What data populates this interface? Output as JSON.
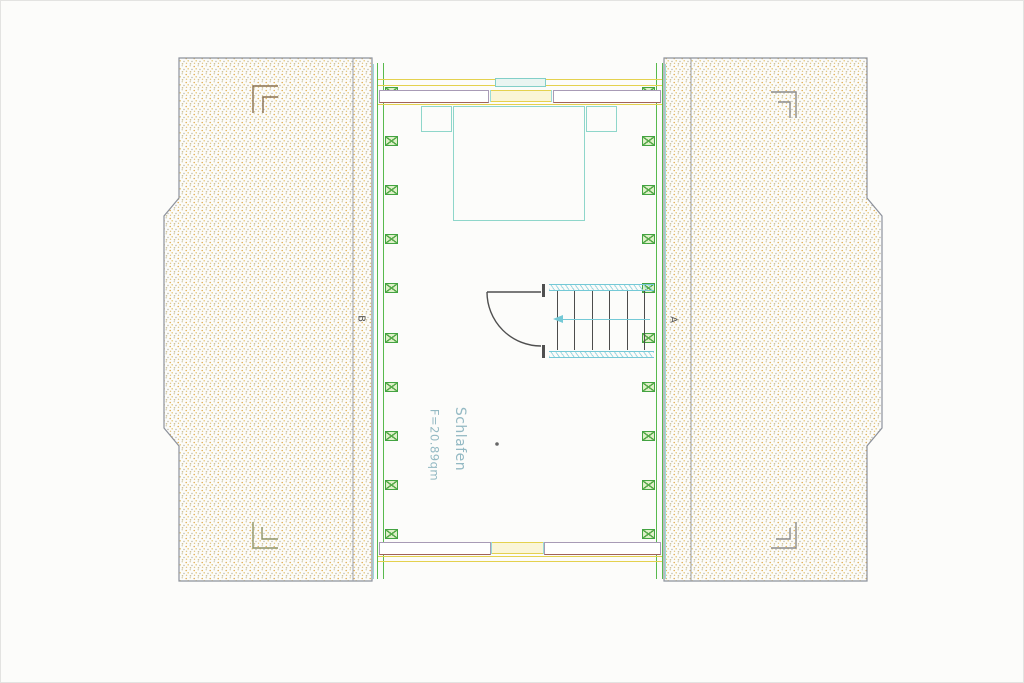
{
  "room": {
    "name": "Schlafen",
    "area": "F=20.89qm"
  },
  "section_markers": {
    "left": "B",
    "right": "A"
  },
  "structure": {
    "rafter_blocks_per_side": 10,
    "stair_tread_lines": 6,
    "stair_direction": "left"
  },
  "colors": {
    "wall_green": "#58ba4d",
    "rafter_fill": "#dff0c9",
    "stipple_orange": "#dfae55",
    "stipple_olive": "#cdc7a4",
    "knee_wall_purple": "#a89bb6",
    "knee_wall_red_edge": "#a2625a",
    "eave_yellow": "#e4d14e",
    "furniture_cyan": "#8ed6ca",
    "stair_cyan": "#74c9d6",
    "label_blue": "#93b9c3",
    "line_dark": "#4f4f4f"
  }
}
